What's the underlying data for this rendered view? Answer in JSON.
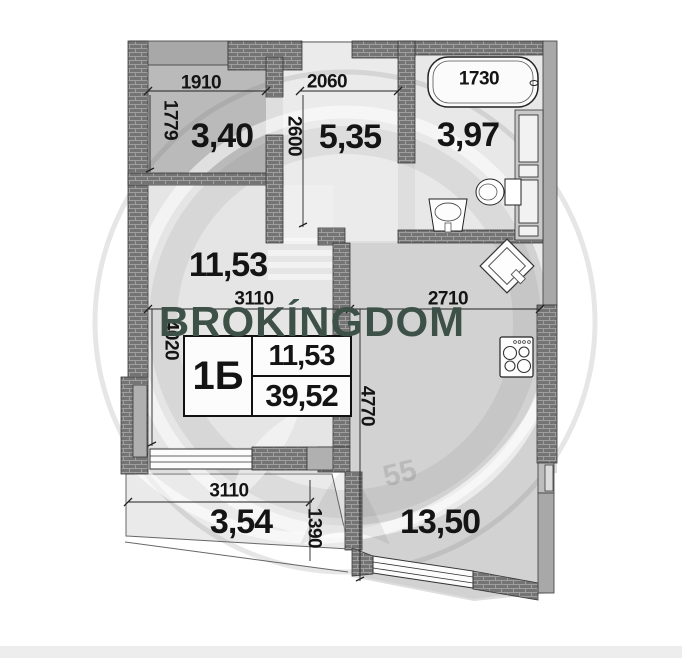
{
  "watermark": {
    "brand": "BROKÍNGDOM",
    "brand_color": "#3e5149",
    "emblem_number": "55"
  },
  "unit_info": {
    "type_label": "1Б",
    "living_area": "11,53",
    "total_area": "39,52"
  },
  "rooms": {
    "wardrobe": {
      "area": "3,40",
      "width_mm": "1910",
      "depth_mm": "1779"
    },
    "hallway": {
      "area": "5,35",
      "width_mm": "2060",
      "depth_mm": "2600"
    },
    "bathroom": {
      "area": "3,97",
      "bathtub_length_mm": "1730"
    },
    "living_room": {
      "area": "11,53",
      "width_mm": "3110",
      "depth_mm": "4020"
    },
    "kitchen": {
      "area": "13,50",
      "width_mm": "2710",
      "depth_mm": "4770"
    },
    "balcony": {
      "area": "3,54",
      "width_mm": "3110",
      "depth_mm": "1390"
    }
  }
}
